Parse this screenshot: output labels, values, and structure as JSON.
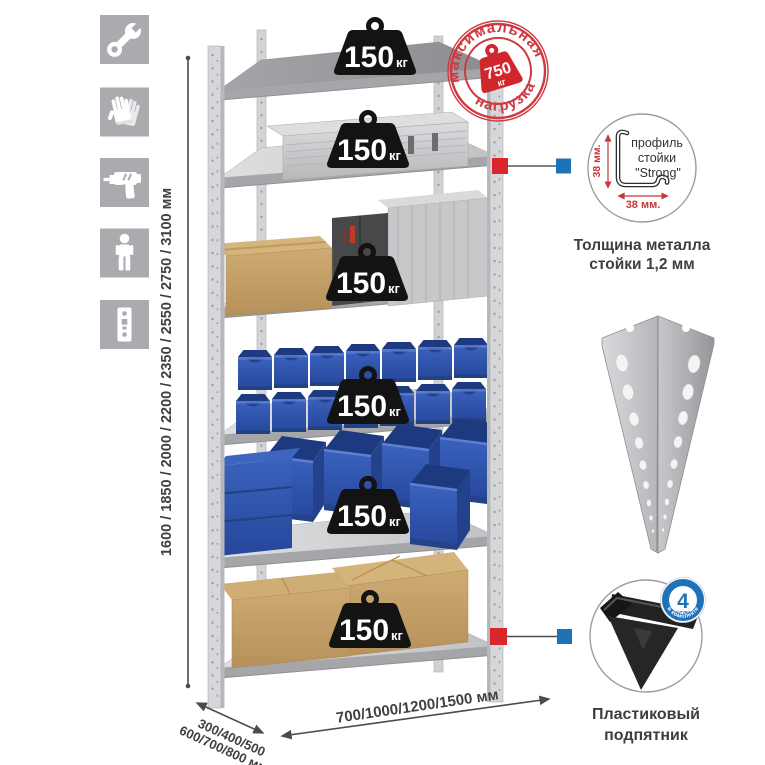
{
  "sidebar": {
    "icons": [
      {
        "name": "wrench"
      },
      {
        "name": "work-gloves"
      },
      {
        "name": "drill"
      },
      {
        "name": "person"
      },
      {
        "name": "perforated-post"
      }
    ]
  },
  "dimensions": {
    "height": "1600 / 1850 / 2000 / 2200 / 2350 / 2550 / 2750 / 3100 мм",
    "depth_line1": "300/400/500",
    "depth_line2": "600/700/800 мм",
    "width": "700/1000/1200/1500 мм"
  },
  "shelf_load": {
    "value": "150",
    "unit": "кг",
    "badge_count": 6
  },
  "max_load_stamp": {
    "arc_top": "максимальная",
    "arc_bottom": "нагрузка",
    "value": "750",
    "unit": "кг"
  },
  "post_profile": {
    "label_line1": "профиль",
    "label_line2": "стойки",
    "label_line3": "\"Strong\"",
    "dim_vertical": "38 мм.",
    "dim_horizontal": "38 мм.",
    "caption_line1": "Толщина металла",
    "caption_line2": "стойки 1,2 мм"
  },
  "plastic_foot": {
    "badge_value": "4",
    "badge_unit": "штуки",
    "badge_arc": "в комплекте",
    "caption_line1": "Пластиковый",
    "caption_line2": "подпятник"
  },
  "colors": {
    "accent_red": "#d2262d",
    "accent_blue": "#1e72b8",
    "bin_blue": "#2e55a8",
    "metal_gray": "#d2d4d6",
    "icon_tile_gray": "#a9abae"
  }
}
